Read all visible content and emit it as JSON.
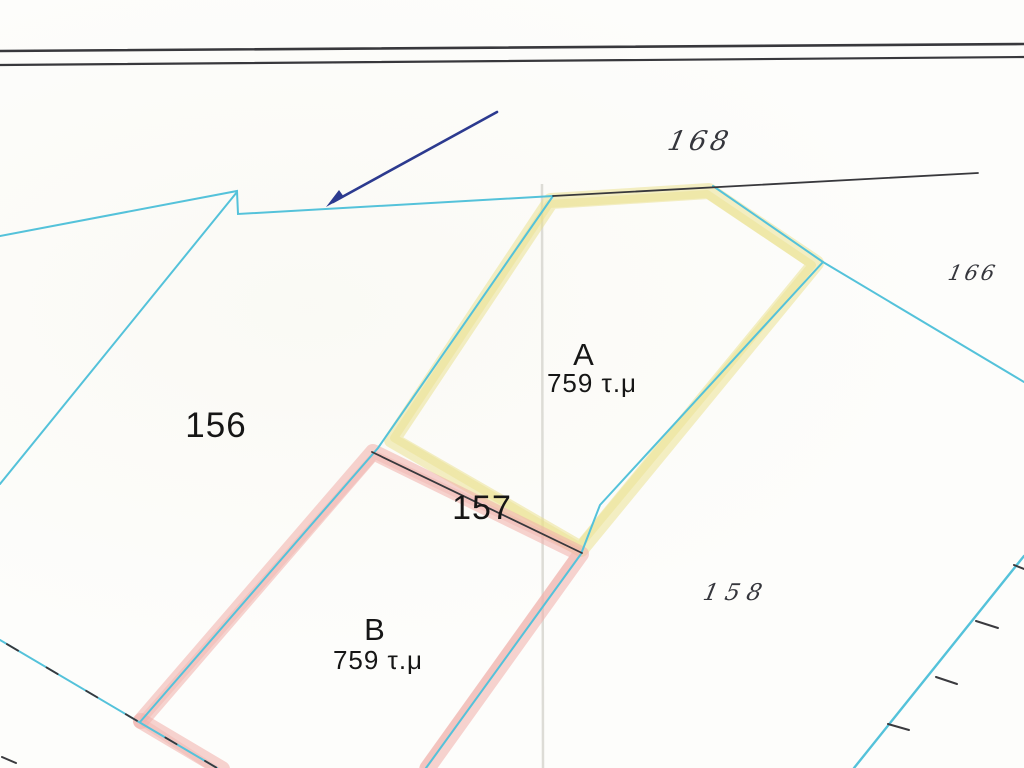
{
  "map": {
    "region_labels": [
      {
        "text": "168",
        "style": "handwritten"
      },
      {
        "text": "166",
        "style": "handwritten"
      },
      {
        "text": "156",
        "style": "printed"
      },
      {
        "text": "157",
        "style": "printed"
      },
      {
        "text": "158",
        "style": "handwritten"
      }
    ],
    "plots": [
      {
        "name": "A",
        "area": "759 τ.μ",
        "highlight": "yellow"
      },
      {
        "name": "B",
        "area": "759 τ.μ",
        "highlight": "red"
      }
    ],
    "colors": {
      "boundary_cyan": "#54c2da",
      "highlight_yellow": "#e9e089",
      "highlight_red": "#f0afa9",
      "annotation_navy": "#2c3a8f",
      "ink_black": "#38383c"
    }
  }
}
